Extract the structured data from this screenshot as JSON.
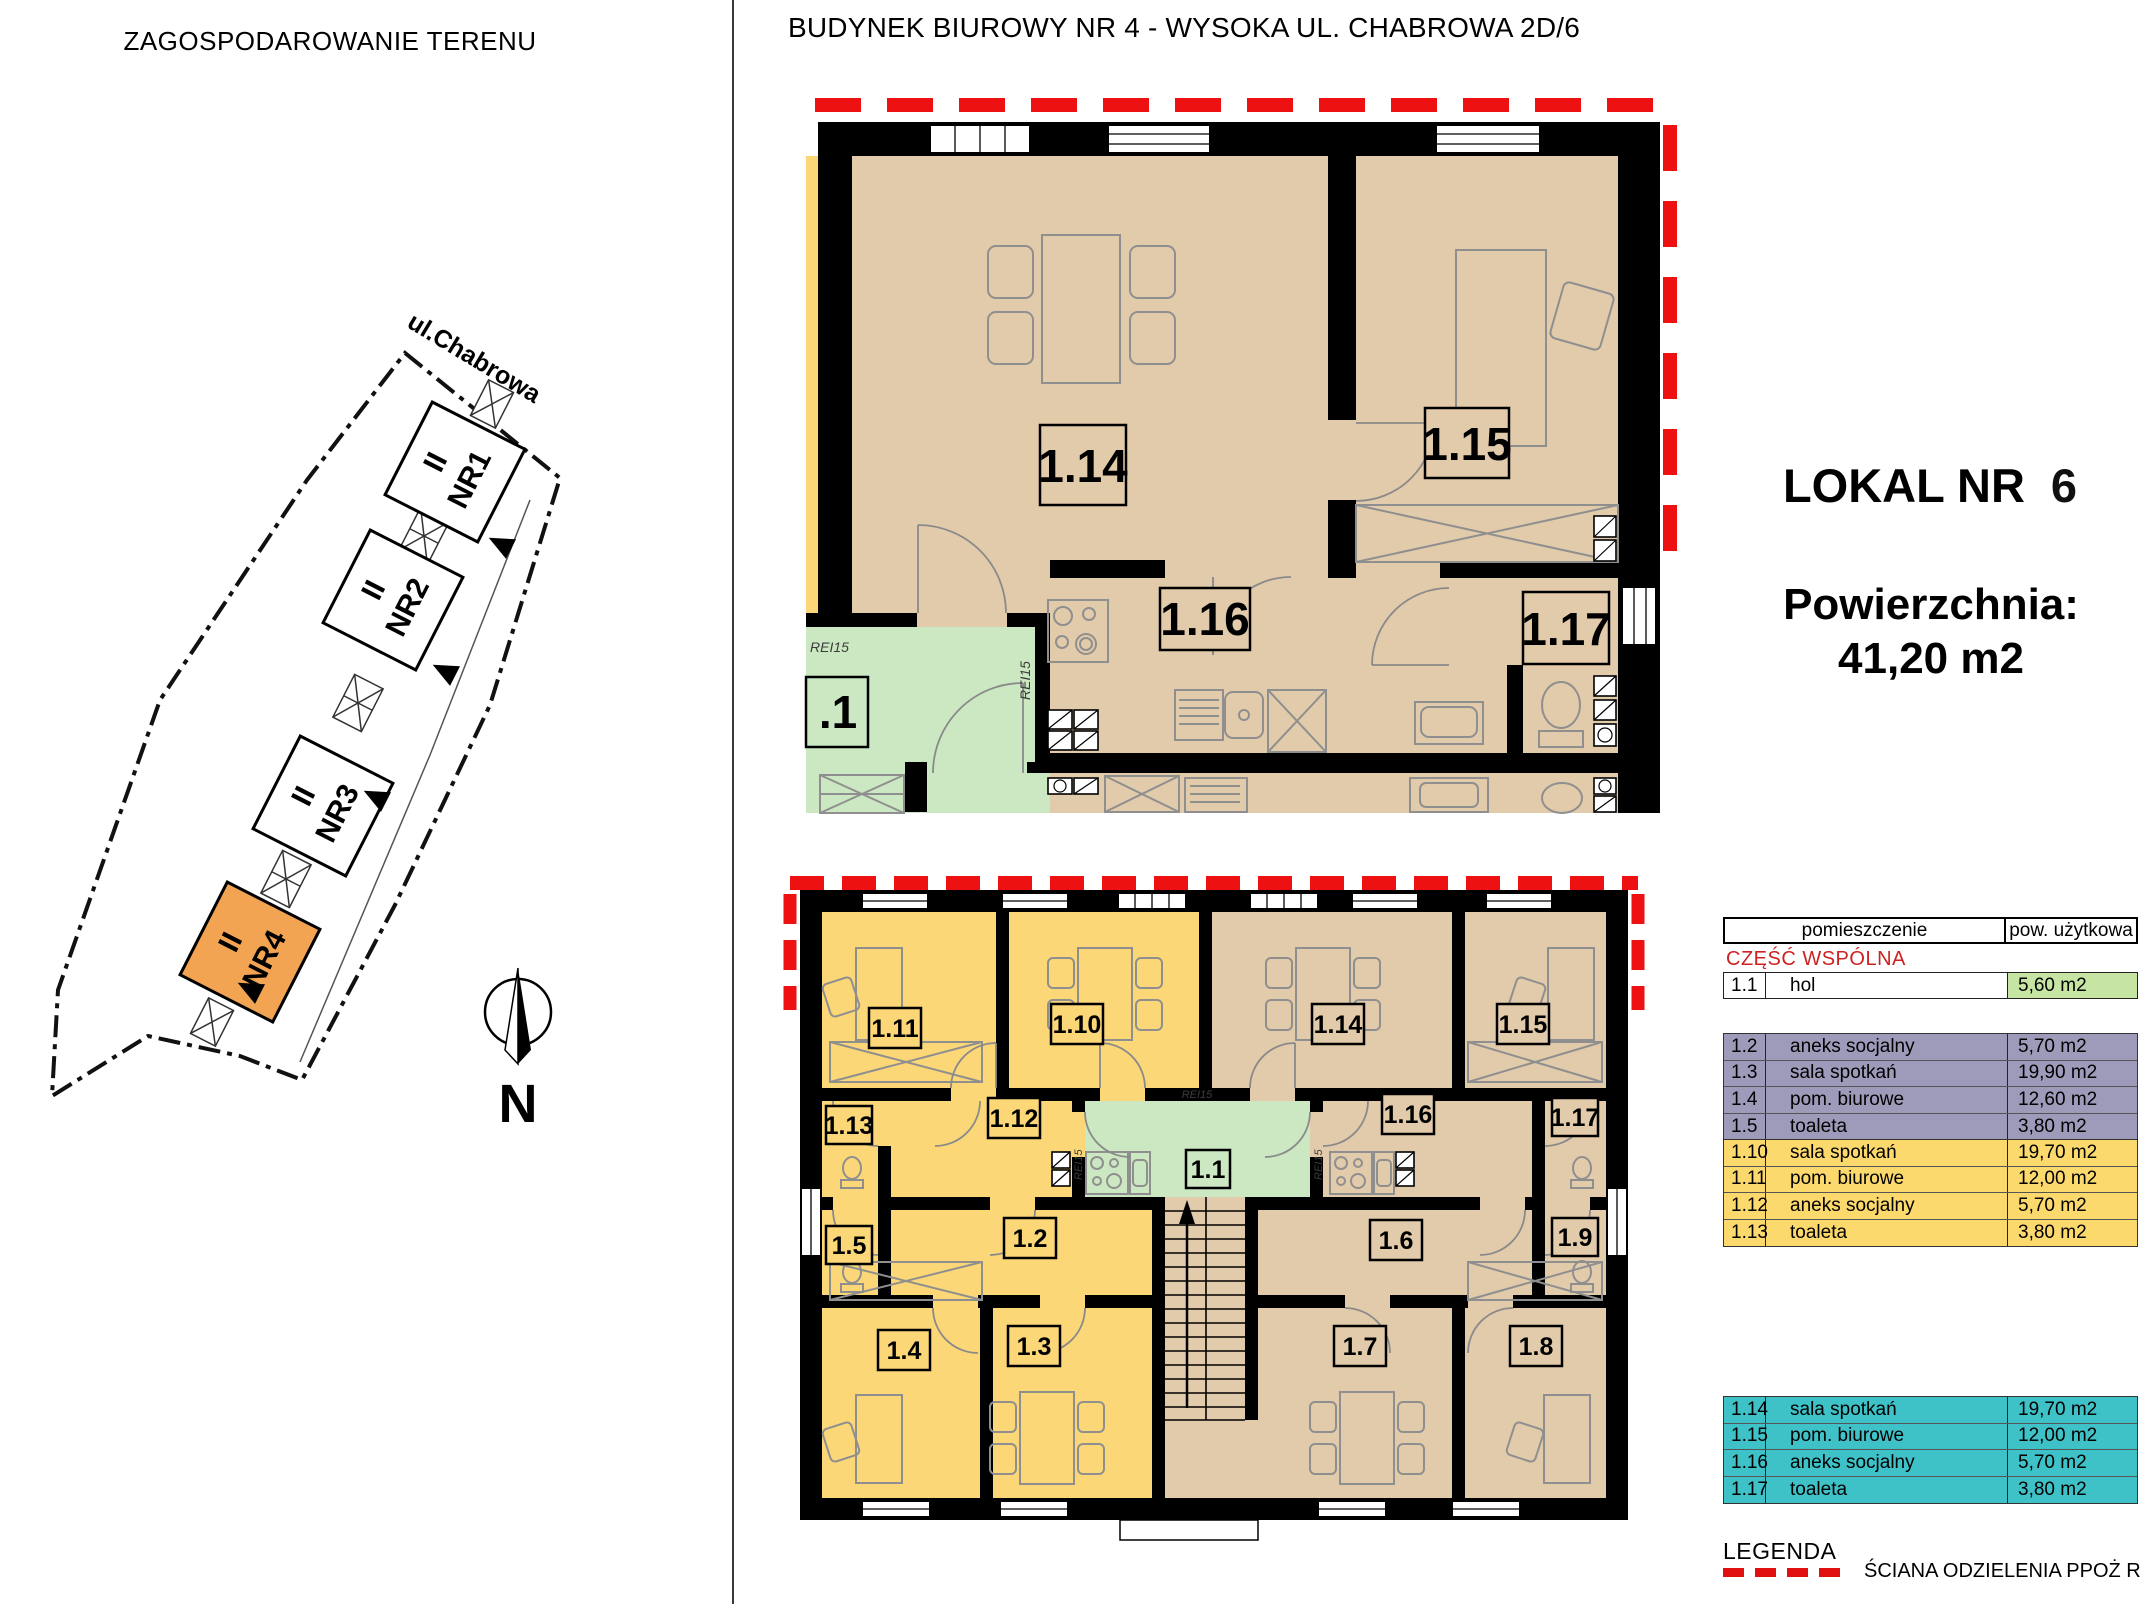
{
  "site": {
    "title": "ZAGOSPODAROWANIE TERENU",
    "street_label": "ul.Chabrowa",
    "compass_label": "N",
    "buildings": [
      {
        "floors": "II",
        "name": "NR1"
      },
      {
        "floors": "II",
        "name": "NR2"
      },
      {
        "floors": "II",
        "name": "NR3"
      },
      {
        "floors": "II",
        "name": "NR4",
        "highlighted": true
      }
    ],
    "highlight_color": "#F3A452"
  },
  "header": {
    "title": "BUDYNEK BIUROWY NR 4 - WYSOKA UL. CHABROWA 2D/6"
  },
  "unit_info": {
    "lokal_label": "LOKAL NR",
    "lokal_number": "6",
    "area_label": "Powierzchnia:",
    "area_value": "41,20 m2"
  },
  "plan_detail": {
    "rooms": [
      {
        "label": "1.14"
      },
      {
        "label": "1.15"
      },
      {
        "label": "1.16"
      },
      {
        "label": "1.17"
      },
      {
        "label": ".1"
      }
    ],
    "fire_labels": [
      "REI15",
      "REI15"
    ]
  },
  "plan_floor": {
    "rooms": [
      {
        "label": "1.11"
      },
      {
        "label": "1.10"
      },
      {
        "label": "1.14"
      },
      {
        "label": "1.15"
      },
      {
        "label": "1.13"
      },
      {
        "label": "1.12"
      },
      {
        "label": "1.16"
      },
      {
        "label": "1.17"
      },
      {
        "label": "1.1"
      },
      {
        "label": "1.5"
      },
      {
        "label": "1.2"
      },
      {
        "label": "1.6"
      },
      {
        "label": "1.9"
      },
      {
        "label": "1.4"
      },
      {
        "label": "1.3"
      },
      {
        "label": "1.7"
      },
      {
        "label": "1.8"
      }
    ],
    "fire_labels": [
      "REI15",
      "REI15",
      "REI15"
    ]
  },
  "room_table": {
    "header": {
      "col1": "pomieszczenie",
      "col2": "pow. użytkowa"
    },
    "common_label": "CZĘŚĆ WSPÓLNA",
    "common_rows": [
      {
        "id": "1.1",
        "name": "hol",
        "area": "5,60 m2"
      }
    ],
    "groups": [
      {
        "color": "purple",
        "rows": [
          {
            "id": "1.2",
            "name": "aneks socjalny",
            "area": "5,70 m2"
          },
          {
            "id": "1.3",
            "name": "sala spotkań",
            "area": "19,90 m2"
          },
          {
            "id": "1.4",
            "name": "pom. biurowe",
            "area": "12,60 m2"
          },
          {
            "id": "1.5",
            "name": "toaleta",
            "area": "3,80 m2"
          }
        ]
      },
      {
        "color": "yellow",
        "rows": [
          {
            "id": "1.10",
            "name": "sala spotkań",
            "area": "19,70 m2"
          },
          {
            "id": "1.11",
            "name": "pom. biurowe",
            "area": "12,00 m2"
          },
          {
            "id": "1.12",
            "name": "aneks socjalny",
            "area": "5,70 m2"
          },
          {
            "id": "1.13",
            "name": "toaleta",
            "area": "3,80 m2"
          }
        ]
      },
      {
        "color": "cyan",
        "rows": [
          {
            "id": "1.14",
            "name": "sala spotkań",
            "area": "19,70 m2"
          },
          {
            "id": "1.15",
            "name": "pom. biurowe",
            "area": "12,00 m2"
          },
          {
            "id": "1.16",
            "name": "aneks socjalny",
            "area": "5,70 m2"
          },
          {
            "id": "1.17",
            "name": "toaleta",
            "area": "3,80 m2"
          }
        ]
      }
    ]
  },
  "legend": {
    "title": "LEGENDA",
    "wall_label": "ŚCIANA ODZIELENIA PPOŻ REI120"
  },
  "colors": {
    "fire_red": "#EE1111",
    "site_highlight_orange": "#F3A452",
    "plan_beige": "#E2CBAA",
    "plan_yellow": "#FBD778",
    "plan_green": "#CBE8C2",
    "table_purple": "#9E9ABA",
    "table_yellow": "#FCD96D",
    "table_cyan": "#3EC1C7",
    "table_green_cell": "#C6E5A3",
    "common_label_red": "#CC2222"
  }
}
